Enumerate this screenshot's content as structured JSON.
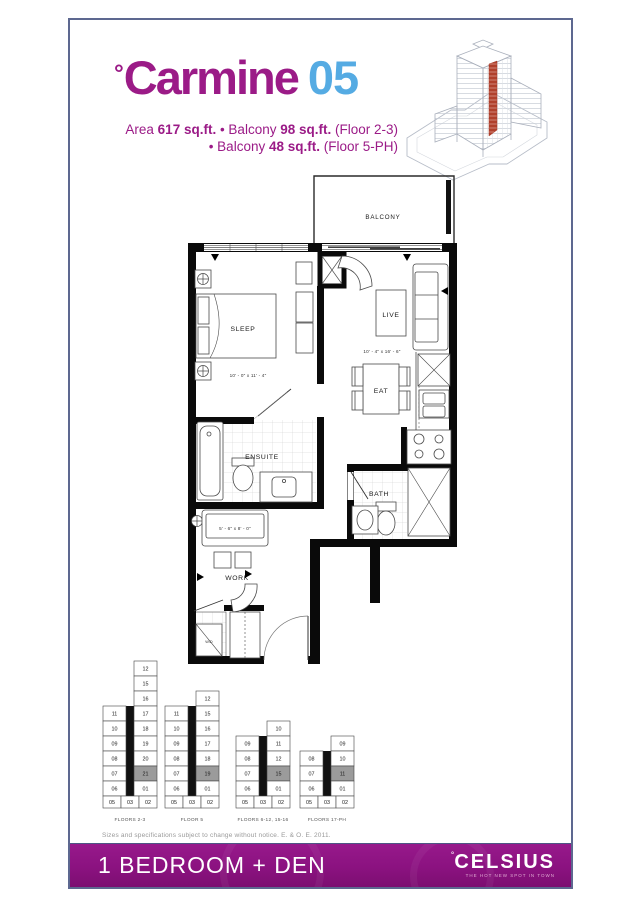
{
  "header": {
    "title": {
      "degree": "°",
      "name": "Carmine",
      "number": "05"
    },
    "spec1": {
      "a": "Area ",
      "b": "617 sq.ft.",
      "c": " • Balcony ",
      "d": "98 sq.ft.",
      "e": " (Floor 2-3)"
    },
    "spec2": {
      "a": "• Balcony ",
      "b": "48 sq.ft.",
      "c": " (Floor 5-PH)"
    }
  },
  "plan": {
    "rooms": {
      "balcony": "BALCONY",
      "sleep": "SLEEP",
      "live": "LIVE",
      "eat": "EAT",
      "ensuite": "ENSUITE",
      "bath": "BATH",
      "work": "WORK",
      "wd": "W/D"
    },
    "dims": {
      "sleep": "10' - 0\" x 11' - 4\"",
      "live": "10' - 4\" x 16' - 6\"",
      "work": "5' - 6\" x 8' - 0\""
    }
  },
  "keyplans": [
    {
      "label": "FLOORS 2-3",
      "highlight": "21",
      "left": [
        "11",
        "10",
        "09",
        "08",
        "07",
        "06"
      ],
      "right": [
        "12",
        "15",
        "16",
        "17",
        "18",
        "19",
        "20",
        "21",
        "01"
      ],
      "bottom": [
        "05",
        "03",
        "02"
      ]
    },
    {
      "label": "FLOOR 5",
      "highlight": "19",
      "left": [
        "11",
        "10",
        "09",
        "08",
        "07",
        "06"
      ],
      "right": [
        "12",
        "15",
        "16",
        "17",
        "18",
        "19",
        "01"
      ],
      "bottom": [
        "05",
        "03",
        "02"
      ]
    },
    {
      "label": "FLOORS 6-12, 15-16",
      "highlight": "15",
      "left": [
        "09",
        "08",
        "07",
        "06"
      ],
      "right": [
        "10",
        "11",
        "12",
        "15",
        "01"
      ],
      "bottom": [
        "05",
        "03",
        "02"
      ]
    },
    {
      "label": "FLOORS 17-PH",
      "highlight": "11",
      "left": [
        "08",
        "07",
        "06"
      ],
      "right": [
        "09",
        "10",
        "11",
        "01"
      ],
      "bottom": [
        "05",
        "03",
        "02"
      ]
    }
  ],
  "fine_print": "Sizes and specifications subject to change without notice. E. & O. E. 2011.",
  "footer": {
    "type_label": "1 BEDROOM + DEN",
    "brand_degree": "°",
    "brand": "CELSIUS",
    "tagline": "the hot new spot in town"
  },
  "colors": {
    "magenta": "#9b1b87",
    "blue": "#55abe3",
    "footer_purple": "#8b1280",
    "highlight_gray": "#9b9b9b",
    "accent_red": "#b0402c"
  }
}
